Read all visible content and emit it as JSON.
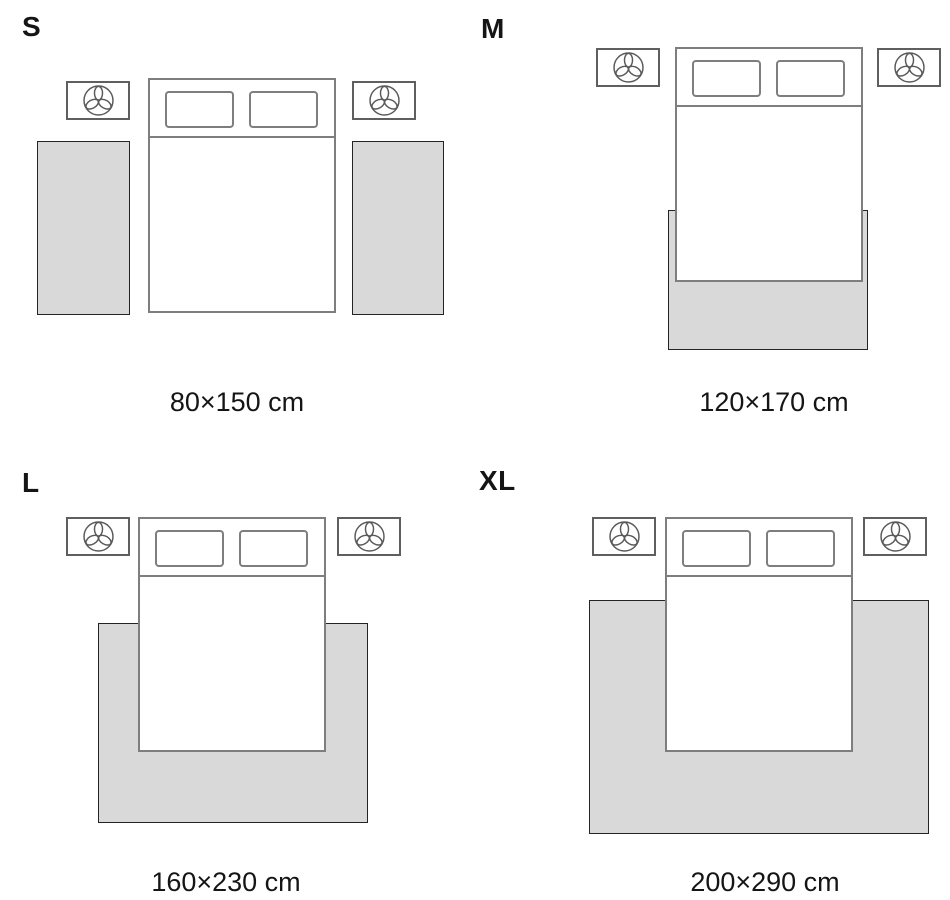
{
  "guide": {
    "quadrants": [
      {
        "id": "s",
        "label": "S",
        "size": "80×150 cm",
        "rug_placement": "two runner rugs, one on each side of the bed"
      },
      {
        "id": "m",
        "label": "M",
        "size": "120×170 cm",
        "rug_placement": "one rug under the lower part of the bed, extending past the foot"
      },
      {
        "id": "l",
        "label": "L",
        "size": "160×230 cm",
        "rug_placement": "one rug under the lower two-thirds of the bed, extending on both sides and past the foot"
      },
      {
        "id": "xl",
        "label": "XL",
        "size": "200×290 cm",
        "rug_placement": "one rug spanning the full width including nightstand zones, extending past the foot"
      }
    ],
    "icons": {
      "nightstand_icon": "plant-icon"
    },
    "colors": {
      "rug_fill": "#d9d9d9",
      "rug_border": "#242424",
      "furniture_border": "#7e7e7e",
      "nightstand_border": "#5f5f5f",
      "text": "#151515"
    }
  }
}
